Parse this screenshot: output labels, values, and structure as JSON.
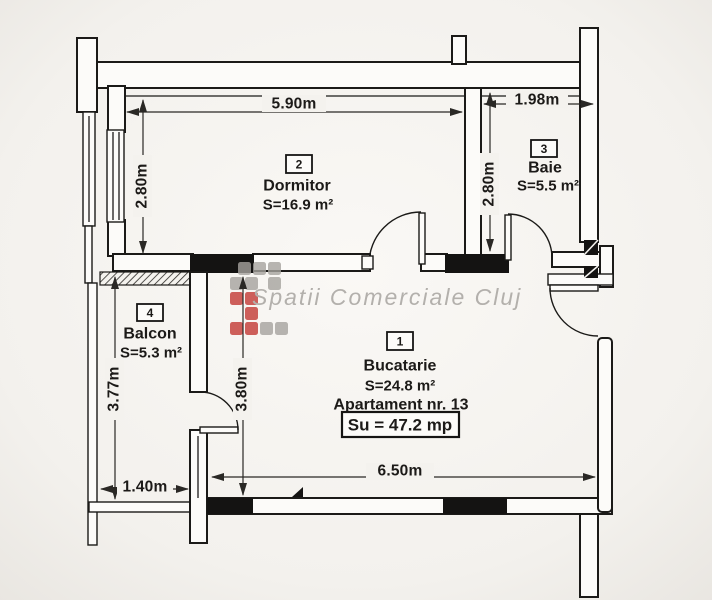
{
  "apartment": {
    "number_label": "Apartament nr. 13",
    "total_area_label": "Su = 47.2 mp"
  },
  "rooms": {
    "bucatarie": {
      "index": "1",
      "name": "Bucatarie",
      "area": "S=24.8 m²"
    },
    "dormitor": {
      "index": "2",
      "name": "Dormitor",
      "area": "S=16.9 m²"
    },
    "baie": {
      "index": "3",
      "name": "Baie",
      "area": "S=5.5 m²"
    },
    "balcon": {
      "index": "4",
      "name": "Balcon",
      "area": "S=5.3 m²"
    }
  },
  "dimensions": {
    "dormitor_width": "5.90m",
    "baie_width": "1.98m",
    "dormitor_height": "2.80m",
    "baie_height": "2.80m",
    "balcon_height": "3.77m",
    "bucatarie_height": "3.80m",
    "balcon_width": "1.40m",
    "bucatarie_width": "6.50m"
  },
  "watermark": {
    "text": "Spatii Comerciale Cluj"
  },
  "colors": {
    "wall_line": "#1b1a18",
    "paper": "#f4f2ee",
    "watermark_gray": "#a5a29e",
    "watermark_red": "#c64440"
  }
}
